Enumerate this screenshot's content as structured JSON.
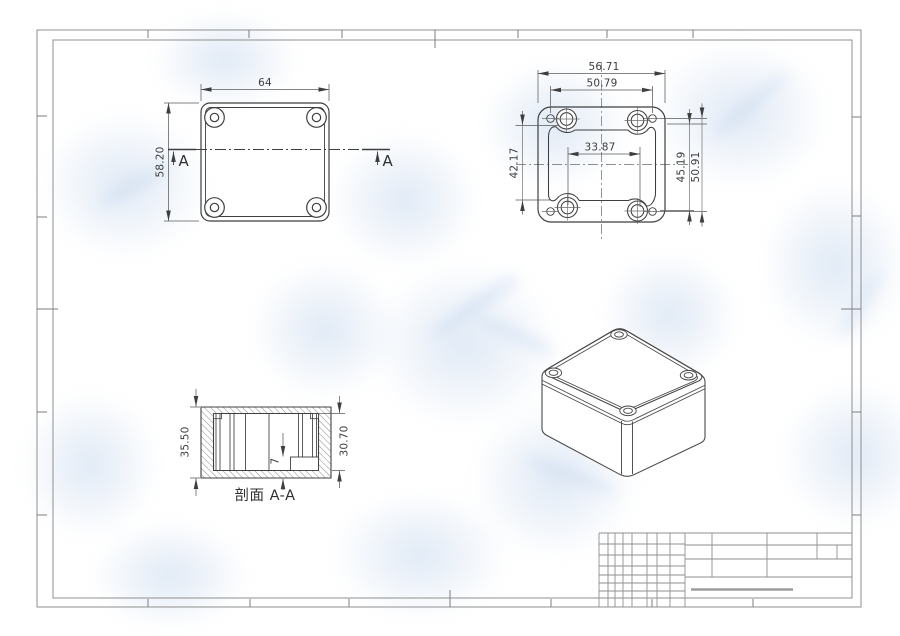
{
  "sheet": {
    "background": "#ffffff",
    "frame_color": "#8f8f8f",
    "drawing_line_color": "#3f3f3f",
    "watermark_color": "#c7d8ee",
    "title_block_accent": "#9c9c9c"
  },
  "views": {
    "top_view": {
      "width_dim": "64",
      "height_dim": "58.20",
      "section_label_left": "A",
      "section_label_right": "A"
    },
    "inside_view": {
      "outer_width_dim": "56.71",
      "hole_pitch_width_dim": "50.79",
      "boss_pitch_width_dim": "33.87",
      "cavity_height_dim": "42.17",
      "boss_pitch_height_dim": "45.19",
      "hole_pitch_height_dim": "50.91"
    },
    "section_view": {
      "caption": "剖面 A-A",
      "outer_height_dim": "35.50",
      "inner_height_dim": "30.70",
      "step_height_dim": "7"
    }
  },
  "title_block": {
    "fields": []
  }
}
